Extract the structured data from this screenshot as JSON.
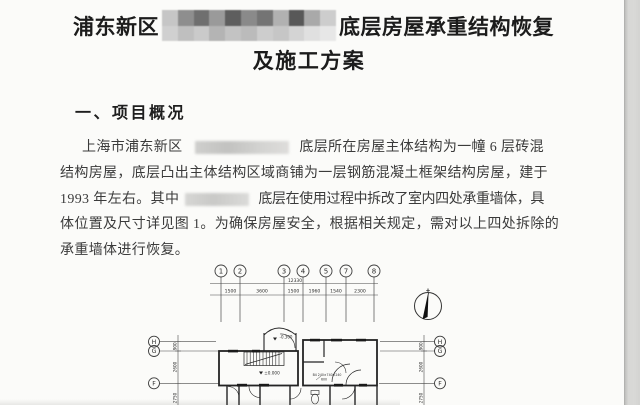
{
  "document": {
    "title": {
      "prefix": "浦东新区",
      "suffix": "底层房屋承重结构恢复",
      "line2": "及施工方案"
    },
    "heading": "一、项目概况",
    "body": {
      "l1_prefix": "上海市浦东新区",
      "l1_suffix": "底层所在房屋主体结构为一幢 6 层砖混",
      "l2": "结构房屋，底层凸出主体结构区域商铺为一层钢筋混凝土框架结构房屋，建于",
      "l3_prefix": "1993 年左右。其中",
      "l3_suffix": "底层在使用过程中拆改了室内四处承重墙体，具",
      "l4": "体位置及尺寸详见图 1。为确保房屋安全，根据相关规定，需对以上四处拆除的",
      "l5": "承重墙体进行恢复。"
    }
  },
  "redactions": {
    "title_mosaic": {
      "rows": [
        [
          "#c6c6c6",
          "#8e8e8e",
          "#6f6f6f",
          "#9a9a9a",
          "#5e5e5e",
          "#8a8a8a",
          "#747474",
          "#b1b1b1",
          "#585858",
          "#a9a9a9",
          "#cdcdcd"
        ],
        [
          "#d0d0d0",
          "#bfbfbf",
          "#cacaca",
          "#b4b4b4",
          "#c3c3c3",
          "#bbbbbb",
          "#cdcdcd",
          "#c6c6c6",
          "#d4d4d4",
          "#e0e0e0",
          "#e7e7e7"
        ]
      ]
    }
  },
  "diagram": {
    "grid_cols": [
      "1",
      "2",
      "3",
      "4",
      "5",
      "7",
      "8"
    ],
    "grid_rows": [
      "H",
      "G",
      "F"
    ],
    "dim_overall": "12330",
    "dim_segments": [
      "1500",
      "3600",
      "1500",
      "1960",
      "1540",
      "2300"
    ],
    "dim_side": [
      "900",
      "2600",
      "2750"
    ],
    "elev_entry": "-0.300",
    "elev_floor": "±0.000",
    "note_line1": "B4 240×740×240",
    "note_line2": "600"
  }
}
